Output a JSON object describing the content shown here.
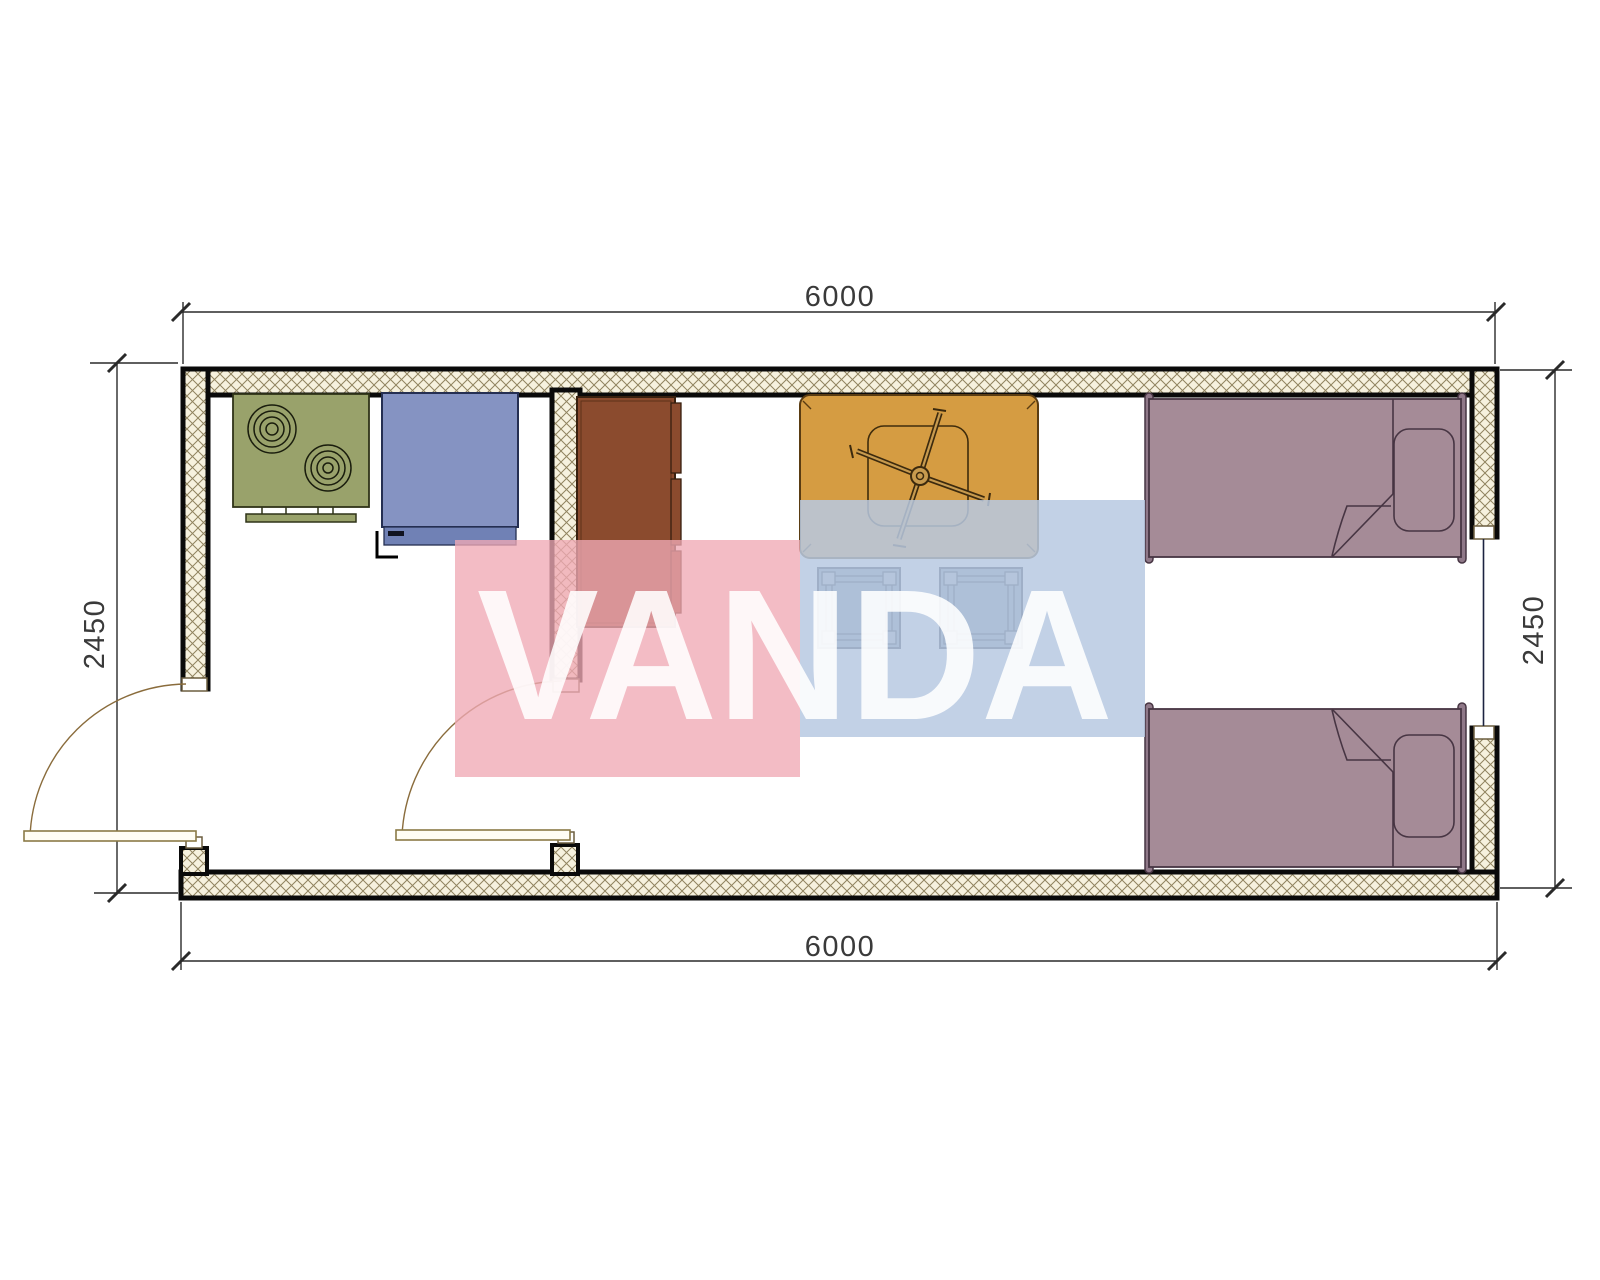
{
  "drawing_title": "container-house-floor-plan",
  "dimensions": {
    "top": "6000",
    "bottom": "6000",
    "left": "2450",
    "right": "2450"
  },
  "watermark": {
    "text": "VANDA",
    "pink_color": "#efa9b5",
    "blue_color": "#b7c9e2",
    "text_color": "#ffffff"
  },
  "symbols": [
    "stove-symbol",
    "washing-machine-symbol",
    "wardrobe-symbol",
    "table-with-ceiling-fan-symbol",
    "stool-symbol",
    "stool-symbol",
    "single-bed-symbol",
    "single-bed-symbol",
    "door-swing-symbol",
    "door-swing-symbol",
    "window-symbol"
  ],
  "colors": {
    "wall_hatch_bg": "#f6f1de",
    "wall_hatch_line": "#90835f",
    "wall_edge": "#0a0a0a",
    "stove": "#99a26b",
    "washer": "#8593c2",
    "washer_strip": "#7081b5",
    "wardrobe": "#8b4b2e",
    "table": "#d59c42",
    "stool": "#7b8ca0",
    "stool_leg": "#a8b0ba",
    "bed": "#a58b97",
    "bed_bar": "#8f7888",
    "door": "#8a6c3c",
    "dim_line": "#2a2a2a"
  }
}
